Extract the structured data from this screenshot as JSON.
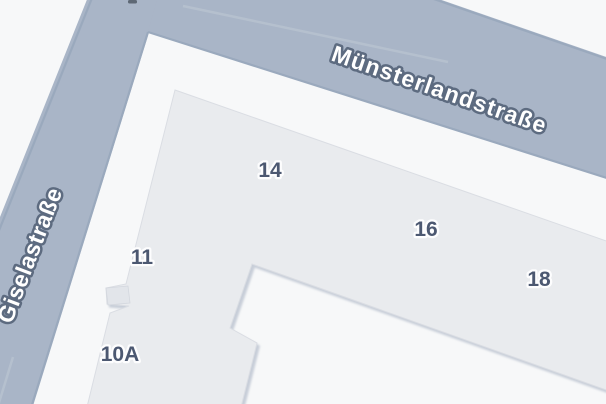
{
  "map": {
    "type_label": "street-map-view",
    "streets": [
      {
        "name": "Münsterlandstraße"
      },
      {
        "name": "Giselastraße"
      }
    ],
    "house_numbers": [
      "14",
      "16",
      "18",
      "11",
      "10A"
    ]
  },
  "colors": {
    "background": "#f7f8f9",
    "road_fill": "#a9b5c7",
    "road_edge": "#9aa9bd",
    "building_fill": "#e9ebee",
    "building_annex_fill": "#e2e5ea",
    "street_label_fill": "#ffffff",
    "street_label_outline": "#5d6b80",
    "house_number_color": "#44516b",
    "house_number_halo": "#ffffff",
    "artifact_color": "#5e6875"
  }
}
